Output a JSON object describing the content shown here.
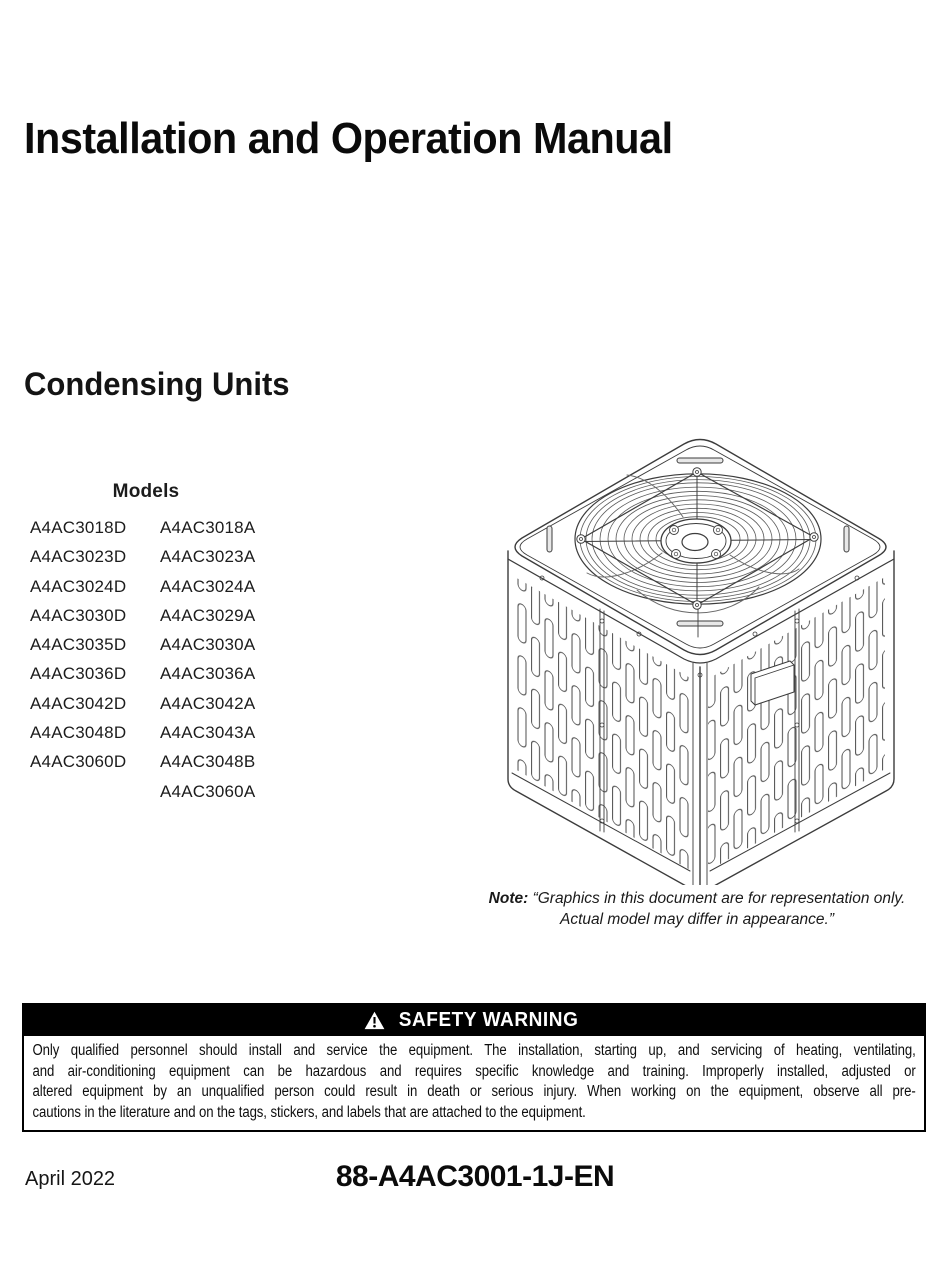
{
  "page": {
    "title": "Installation and Operation Manual",
    "section_title": "Condensing Units"
  },
  "models": {
    "heading": "Models",
    "column1": [
      "A4AC3018D",
      "A4AC3023D",
      "A4AC3024D",
      "A4AC3030D",
      "A4AC3035D",
      "A4AC3036D",
      "A4AC3042D",
      "A4AC3048D",
      "A4AC3060D",
      ""
    ],
    "column2": [
      "A4AC3018A",
      "A4AC3023A",
      "A4AC3024A",
      "A4AC3029A",
      "A4AC3030A",
      "A4AC3036A",
      "A4AC3042A",
      "A4AC3043A",
      "A4AC3048B",
      "A4AC3060A"
    ]
  },
  "illustration": {
    "name": "condensing-unit-line-drawing",
    "description": "Isometric line drawing of a condensing unit with circular top fan grille and louvered side panels"
  },
  "note": {
    "label": "Note:",
    "line1": "“Graphics in this document are for representation only.",
    "line2": "Actual model may differ in appearance.”"
  },
  "safety_warning": {
    "icon": "warning-triangle-icon",
    "title": "SAFETY WARNING",
    "lines": [
      "Only qualified personnel should install and service the equipment. The installation, starting up, and servicing of heating, ventilating,",
      "and air-conditioning equipment can be hazardous and requires specific knowledge and training. Improperly installed, adjusted or",
      "altered equipment by an unqualified person could result in death or serious injury. When working on the equipment, observe all pre-",
      "cautions in the literature and on the tags, stickers, and labels that are attached to the equipment."
    ]
  },
  "footer": {
    "date": "April 2022",
    "document_number": "88-A4AC3001-1J-EN"
  },
  "colors": {
    "text": "#111111",
    "warning_header_bg": "#000000",
    "warning_header_text": "#ffffff",
    "line_art": "#3c3c3c"
  }
}
